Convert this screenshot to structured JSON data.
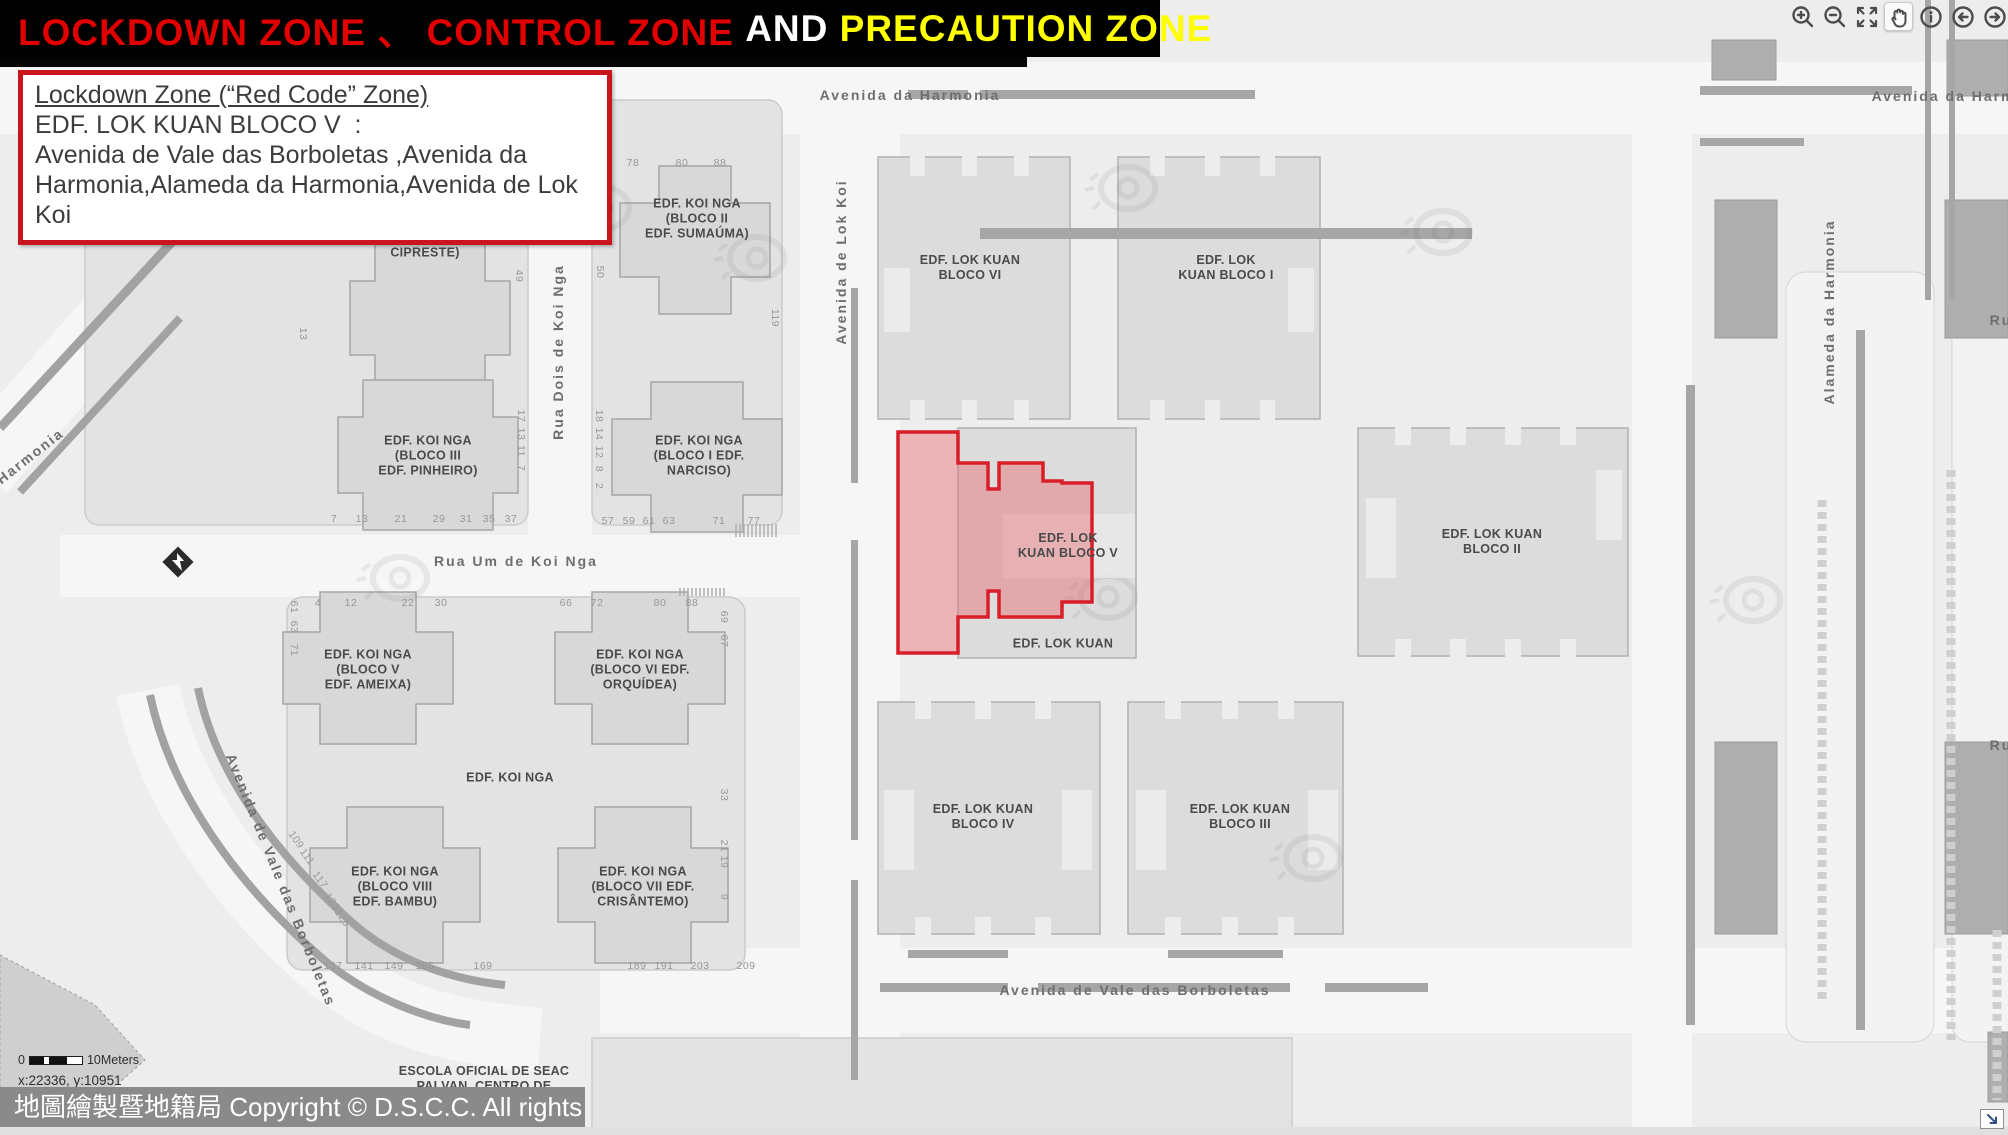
{
  "title_bar": {
    "segments": [
      {
        "text": "LOCKDOWN ZONE 、 CONTROL ZONE ",
        "color": "#e00000"
      },
      {
        "text": "AND ",
        "color": "#ffffff"
      },
      {
        "text": "PRECAUTION ZONE",
        "color": "#ffff00"
      }
    ]
  },
  "info_box": {
    "heading": "Lockdown Zone (“Red Code” Zone)",
    "subheading": "EDF. LOK KUAN BLOCO V  :",
    "body": "Avenida de Vale das Borboletas ,Avenida da Harmonia,Alameda da Harmonia,Avenida de Lok Koi"
  },
  "toolbar": {
    "tools": [
      "zoom-in",
      "zoom-out",
      "full-extent",
      "pan",
      "identify",
      "previous-extent",
      "next-extent"
    ],
    "active_tool": "pan"
  },
  "map": {
    "street_labels": [
      {
        "t": "Avenida da Harmonia",
        "x": 910,
        "y": 95,
        "r": 0
      },
      {
        "t": "Avenida da Harmonia",
        "x": 1962,
        "y": 96,
        "r": 0
      },
      {
        "t": "Avenida de Lok Koi",
        "x": 841,
        "y": 262,
        "r": -90
      },
      {
        "t": "Rua Dois de Koi Nga",
        "x": 558,
        "y": 352,
        "r": -90
      },
      {
        "t": "Rua Um de Koi Nga",
        "x": 516,
        "y": 561,
        "r": 0
      },
      {
        "t": "Avenida de Vale das Borboletas",
        "x": 281,
        "y": 880,
        "r": 68
      },
      {
        "t": "Avenida de Vale das Borboletas",
        "x": 1135,
        "y": 990,
        "r": 0
      },
      {
        "t": "Alameda da Harmonia",
        "x": 1829,
        "y": 312,
        "r": -90
      },
      {
        "t": "Harmonia",
        "x": 30,
        "y": 456,
        "r": -38
      },
      {
        "t": "Ru",
        "x": 2001,
        "y": 320,
        "r": 0
      },
      {
        "t": "Ru",
        "x": 2001,
        "y": 745,
        "r": 0
      }
    ],
    "building_labels": [
      {
        "lines": [
          "CIPRESTE)"
        ],
        "x": 425,
        "y": 253
      },
      {
        "lines": [
          "EDF. KOI NGA",
          "(BLOCO II",
          "EDF. SUMAÚMA)"
        ],
        "x": 697,
        "y": 219
      },
      {
        "lines": [
          "EDF. KOI NGA",
          "(BLOCO III",
          "EDF. PINHEIRO)"
        ],
        "x": 428,
        "y": 456
      },
      {
        "lines": [
          "EDF. KOI NGA",
          "(BLOCO I EDF.",
          "NARCISO)"
        ],
        "x": 699,
        "y": 456
      },
      {
        "lines": [
          "EDF. KOI NGA",
          "(BLOCO V",
          "EDF. AMEIXA)"
        ],
        "x": 368,
        "y": 670
      },
      {
        "lines": [
          "EDF. KOI NGA",
          "(BLOCO VI EDF.",
          "ORQUÍDEA)"
        ],
        "x": 640,
        "y": 670
      },
      {
        "lines": [
          "EDF. KOI NGA"
        ],
        "x": 510,
        "y": 778
      },
      {
        "lines": [
          "EDF. KOI NGA",
          "(BLOCO VIII",
          "EDF. BAMBU)"
        ],
        "x": 395,
        "y": 887
      },
      {
        "lines": [
          "EDF. KOI NGA",
          "(BLOCO VII EDF.",
          "CRISÂNTEMO)"
        ],
        "x": 643,
        "y": 887
      },
      {
        "lines": [
          "EDF. LOK KUAN",
          "BLOCO VI"
        ],
        "x": 970,
        "y": 268
      },
      {
        "lines": [
          "EDF. LOK",
          "KUAN BLOCO I"
        ],
        "x": 1226,
        "y": 268
      },
      {
        "lines": [
          "EDF. LOK",
          "KUAN BLOCO V"
        ],
        "x": 1068,
        "y": 546
      },
      {
        "lines": [
          "EDF. LOK KUAN"
        ],
        "x": 1063,
        "y": 644
      },
      {
        "lines": [
          "EDF. LOK KUAN",
          "BLOCO II"
        ],
        "x": 1492,
        "y": 542
      },
      {
        "lines": [
          "EDF. LOK KUAN",
          "BLOCO IV"
        ],
        "x": 983,
        "y": 817
      },
      {
        "lines": [
          "EDF. LOK KUAN",
          "BLOCO III"
        ],
        "x": 1240,
        "y": 817
      },
      {
        "lines": [
          "ESCOLA OFICIAL DE SEAC",
          "PAI VAN, CENTRO DE"
        ],
        "x": 484,
        "y": 1079
      }
    ],
    "house_numbers": [
      {
        "t": "78",
        "x": 633,
        "y": 163,
        "r": 0
      },
      {
        "t": "80",
        "x": 682,
        "y": 163,
        "r": 0
      },
      {
        "t": "88",
        "x": 720,
        "y": 163,
        "r": 0
      },
      {
        "t": "49",
        "x": 519,
        "y": 276,
        "r": 90
      },
      {
        "t": "50",
        "x": 600,
        "y": 272,
        "r": 90
      },
      {
        "t": "119",
        "x": 775,
        "y": 318,
        "r": 90
      },
      {
        "t": "13",
        "x": 303,
        "y": 334,
        "r": 90
      },
      {
        "t": "17",
        "x": 521,
        "y": 416,
        "r": 90
      },
      {
        "t": "13",
        "x": 521,
        "y": 434,
        "r": 90
      },
      {
        "t": "11",
        "x": 521,
        "y": 451,
        "r": 90
      },
      {
        "t": "7",
        "x": 521,
        "y": 468,
        "r": 90
      },
      {
        "t": "18",
        "x": 599,
        "y": 416,
        "r": 90
      },
      {
        "t": "14",
        "x": 599,
        "y": 434,
        "r": 90
      },
      {
        "t": "12",
        "x": 599,
        "y": 452,
        "r": 90
      },
      {
        "t": "8",
        "x": 599,
        "y": 469,
        "r": 90
      },
      {
        "t": "2",
        "x": 599,
        "y": 486,
        "r": 90
      },
      {
        "t": "7",
        "x": 334,
        "y": 519,
        "r": 0
      },
      {
        "t": "13",
        "x": 362,
        "y": 519,
        "r": 0
      },
      {
        "t": "21",
        "x": 401,
        "y": 519,
        "r": 0
      },
      {
        "t": "29",
        "x": 439,
        "y": 519,
        "r": 0
      },
      {
        "t": "31",
        "x": 466,
        "y": 519,
        "r": 0
      },
      {
        "t": "35",
        "x": 489,
        "y": 519,
        "r": 0
      },
      {
        "t": "37",
        "x": 511,
        "y": 519,
        "r": 0
      },
      {
        "t": "57",
        "x": 608,
        "y": 521,
        "r": 0
      },
      {
        "t": "59",
        "x": 629,
        "y": 521,
        "r": 0
      },
      {
        "t": "61",
        "x": 649,
        "y": 521,
        "r": 0
      },
      {
        "t": "63",
        "x": 669,
        "y": 521,
        "r": 0
      },
      {
        "t": "71",
        "x": 719,
        "y": 521,
        "r": 0
      },
      {
        "t": "77",
        "x": 754,
        "y": 521,
        "r": 0
      },
      {
        "t": "61",
        "x": 294,
        "y": 607,
        "r": 90
      },
      {
        "t": "63",
        "x": 294,
        "y": 627,
        "r": 90
      },
      {
        "t": "71",
        "x": 294,
        "y": 650,
        "r": 90
      },
      {
        "t": "4",
        "x": 318,
        "y": 603,
        "r": 0
      },
      {
        "t": "12",
        "x": 351,
        "y": 603,
        "r": 0
      },
      {
        "t": "22",
        "x": 408,
        "y": 603,
        "r": 0
      },
      {
        "t": "30",
        "x": 441,
        "y": 603,
        "r": 0
      },
      {
        "t": "66",
        "x": 566,
        "y": 603,
        "r": 0
      },
      {
        "t": "72",
        "x": 597,
        "y": 603,
        "r": 0
      },
      {
        "t": "80",
        "x": 660,
        "y": 603,
        "r": 0
      },
      {
        "t": "88",
        "x": 692,
        "y": 603,
        "r": 0
      },
      {
        "t": "69",
        "x": 724,
        "y": 617,
        "r": 90
      },
      {
        "t": "67",
        "x": 724,
        "y": 641,
        "r": 90
      },
      {
        "t": "33",
        "x": 724,
        "y": 795,
        "r": 90
      },
      {
        "t": "21",
        "x": 724,
        "y": 846,
        "r": 90
      },
      {
        "t": "19",
        "x": 724,
        "y": 862,
        "r": 90
      },
      {
        "t": "9",
        "x": 724,
        "y": 897,
        "r": 90
      },
      {
        "t": "109",
        "x": 296,
        "y": 840,
        "r": 55
      },
      {
        "t": "111",
        "x": 307,
        "y": 857,
        "r": 55
      },
      {
        "t": "117",
        "x": 320,
        "y": 880,
        "r": 55
      },
      {
        "t": "123",
        "x": 332,
        "y": 902,
        "r": 55
      },
      {
        "t": "125",
        "x": 342,
        "y": 918,
        "r": 55
      },
      {
        "t": "137",
        "x": 333,
        "y": 966,
        "r": 0
      },
      {
        "t": "141",
        "x": 364,
        "y": 966,
        "r": 0
      },
      {
        "t": "149",
        "x": 394,
        "y": 966,
        "r": 0
      },
      {
        "t": "155",
        "x": 425,
        "y": 966,
        "r": 0
      },
      {
        "t": "169",
        "x": 483,
        "y": 966,
        "r": 0
      },
      {
        "t": "189",
        "x": 637,
        "y": 966,
        "r": 0
      },
      {
        "t": "191",
        "x": 664,
        "y": 966,
        "r": 0
      },
      {
        "t": "203",
        "x": 700,
        "y": 966,
        "r": 0
      },
      {
        "t": "209",
        "x": 746,
        "y": 966,
        "r": 0
      }
    ],
    "red_zone_building": "EDF. LOK KUAN BLOCO V"
  },
  "scale_bar": {
    "start": "0",
    "end": "10Meters"
  },
  "coordinates": "x:22336, y:10951",
  "copyright": "地圖繪製暨地籍局 Copyright © D.S.C.C. All rights reserved",
  "colors": {
    "title_red": "#e00000",
    "title_yellow": "#ffff00",
    "zone_fill": "#e74c56",
    "zone_border": "#d81e28",
    "copyright_bg": "#8a8a8a"
  }
}
